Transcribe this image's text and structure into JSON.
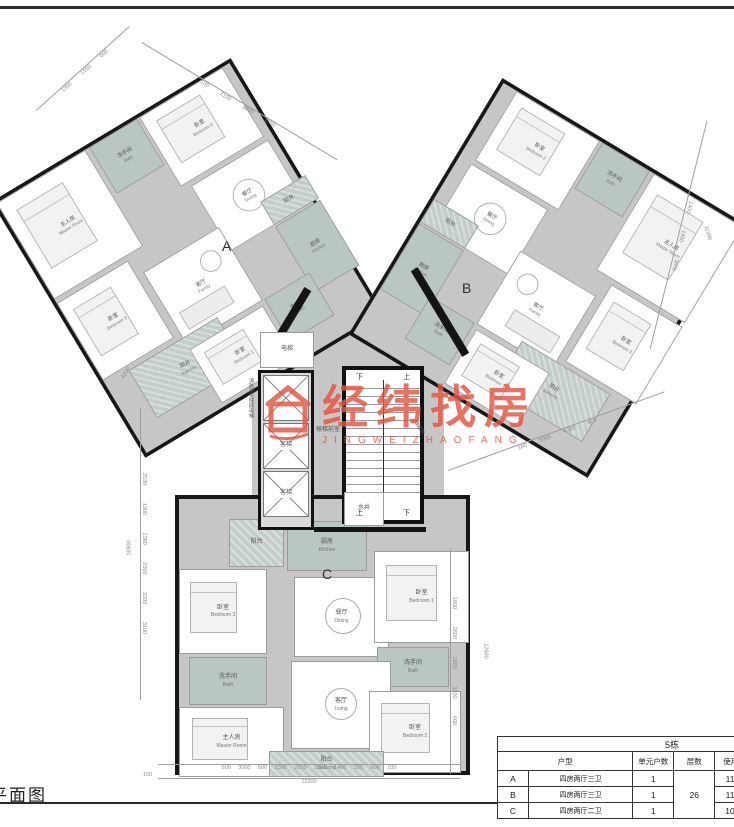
{
  "page": {
    "plan_label": "平面图"
  },
  "watermark": {
    "brand": "经纬找房",
    "sub": "JINGWEIZHAOFANG",
    "color": "#e05643"
  },
  "plan": {
    "letters": {
      "a": "A",
      "b": "B",
      "c": "C"
    },
    "stairs": {
      "up": "上",
      "down": "下"
    },
    "core": {
      "elevator": "电梯",
      "fire_elevator": "消防兼无障碍电梯",
      "passenger": "客梯",
      "lobby": "候梯前室",
      "water_shaft": "水井",
      "smoke_shaft": "油烟井"
    },
    "units": {
      "a": {
        "rooms": {
          "master": {
            "cn": "主人房",
            "en": "Master Room"
          },
          "bed1": {
            "cn": "卧室",
            "en": "Bedroom 1"
          },
          "bed2": {
            "cn": "卧室",
            "en": "Bedroom 2"
          },
          "bed3": {
            "cn": "卧室",
            "en": "Bedroom 3"
          },
          "bath1": {
            "cn": "洗手间",
            "en": "Bath"
          },
          "bath2": {
            "cn": "洗手间",
            "en": "Bath"
          },
          "dining": {
            "cn": "餐厅",
            "en": "Dining"
          },
          "kitchen": {
            "cn": "厨房",
            "en": "Kitchen"
          },
          "living": {
            "cn": "客厅",
            "en": "Family"
          },
          "balc1": {
            "cn": "阳台",
            "en": "Balcony"
          },
          "balc2": {
            "cn": "阳台",
            "en": ""
          }
        }
      },
      "b": {
        "rooms": {
          "master": {
            "cn": "主人房",
            "en": "Master Room"
          },
          "bed1": {
            "cn": "卧室",
            "en": "Bedroom 1"
          },
          "bed2": {
            "cn": "卧室",
            "en": "Bedroom 2"
          },
          "bed3": {
            "cn": "卧室",
            "en": "Bedroom 3"
          },
          "bath1": {
            "cn": "洗手间",
            "en": "Bath"
          },
          "bath2": {
            "cn": "洗手间",
            "en": "Bath"
          },
          "dining": {
            "cn": "餐厅",
            "en": "Dining"
          },
          "kitchen": {
            "cn": "厨房",
            "en": "Kitchen"
          },
          "living": {
            "cn": "客厅",
            "en": "Family"
          },
          "balc1": {
            "cn": "阳台",
            "en": "Balcony"
          },
          "balc2": {
            "cn": "阳台",
            "en": ""
          }
        }
      },
      "c": {
        "rooms": {
          "master": {
            "cn": "主人房",
            "en": "Master Room"
          },
          "bed1": {
            "cn": "卧室",
            "en": "Bedroom 1"
          },
          "bed2": {
            "cn": "卧室",
            "en": "Bedroom 2"
          },
          "bed3": {
            "cn": "卧室",
            "en": "Bedroom 3"
          },
          "bath1": {
            "cn": "洗手间",
            "en": "Bath"
          },
          "bath2": {
            "cn": "洗手间",
            "en": "Bath"
          },
          "dining": {
            "cn": "餐厅",
            "en": "Dining"
          },
          "kitchen": {
            "cn": "厨房",
            "en": "Kitchen"
          },
          "living": {
            "cn": "客厅",
            "en": "Living"
          },
          "balc1": {
            "cn": "阳台",
            "en": ""
          },
          "balc2": {
            "cn": "阳台",
            "en": "Balcony"
          }
        }
      }
    }
  },
  "dims": {
    "top_left": [
      "1350",
      "1550",
      "600"
    ],
    "top_a": [
      "100",
      "2100",
      "3000",
      "1750"
    ],
    "right_b": [
      "1400",
      "1450",
      "3600"
    ],
    "right_b_total": "11300",
    "b_lower": [
      "100",
      "5000",
      "4200",
      "600"
    ],
    "left": [
      "2530",
      "1300",
      "1360",
      "2500",
      "2500",
      "3100"
    ],
    "left_total": "16900",
    "bottom": [
      "600",
      "3000",
      "500",
      "2300",
      "2200",
      "1500",
      "1400",
      "200",
      "600",
      "100"
    ],
    "bottom_total": "12200",
    "bottom_left_tick": "100",
    "right_c": [
      "1800",
      "2600",
      "1800",
      "3100",
      "600"
    ],
    "right_c_total": "12600",
    "a_left": "4200"
  },
  "table": {
    "building": "5栋",
    "headers": {
      "type": "户型",
      "count": "单元户数",
      "floors": "层数",
      "usable": "使用面积",
      "balcony": "阳台面积",
      "inner": "套内面积"
    },
    "floors_value": "26",
    "rows": [
      {
        "unit": "A",
        "type": "四房两厅三卫",
        "count": "1",
        "usable": "118.82",
        "balcony": "9.96",
        "inner": "113"
      },
      {
        "unit": "B",
        "type": "四房两厅三卫",
        "count": "1",
        "usable": "118.82",
        "balcony": "9.96",
        "inner": "113"
      },
      {
        "unit": "C",
        "type": "四房两厅二卫",
        "count": "1",
        "usable": "105.93",
        "balcony": "9.28",
        "inner": "101"
      }
    ]
  }
}
